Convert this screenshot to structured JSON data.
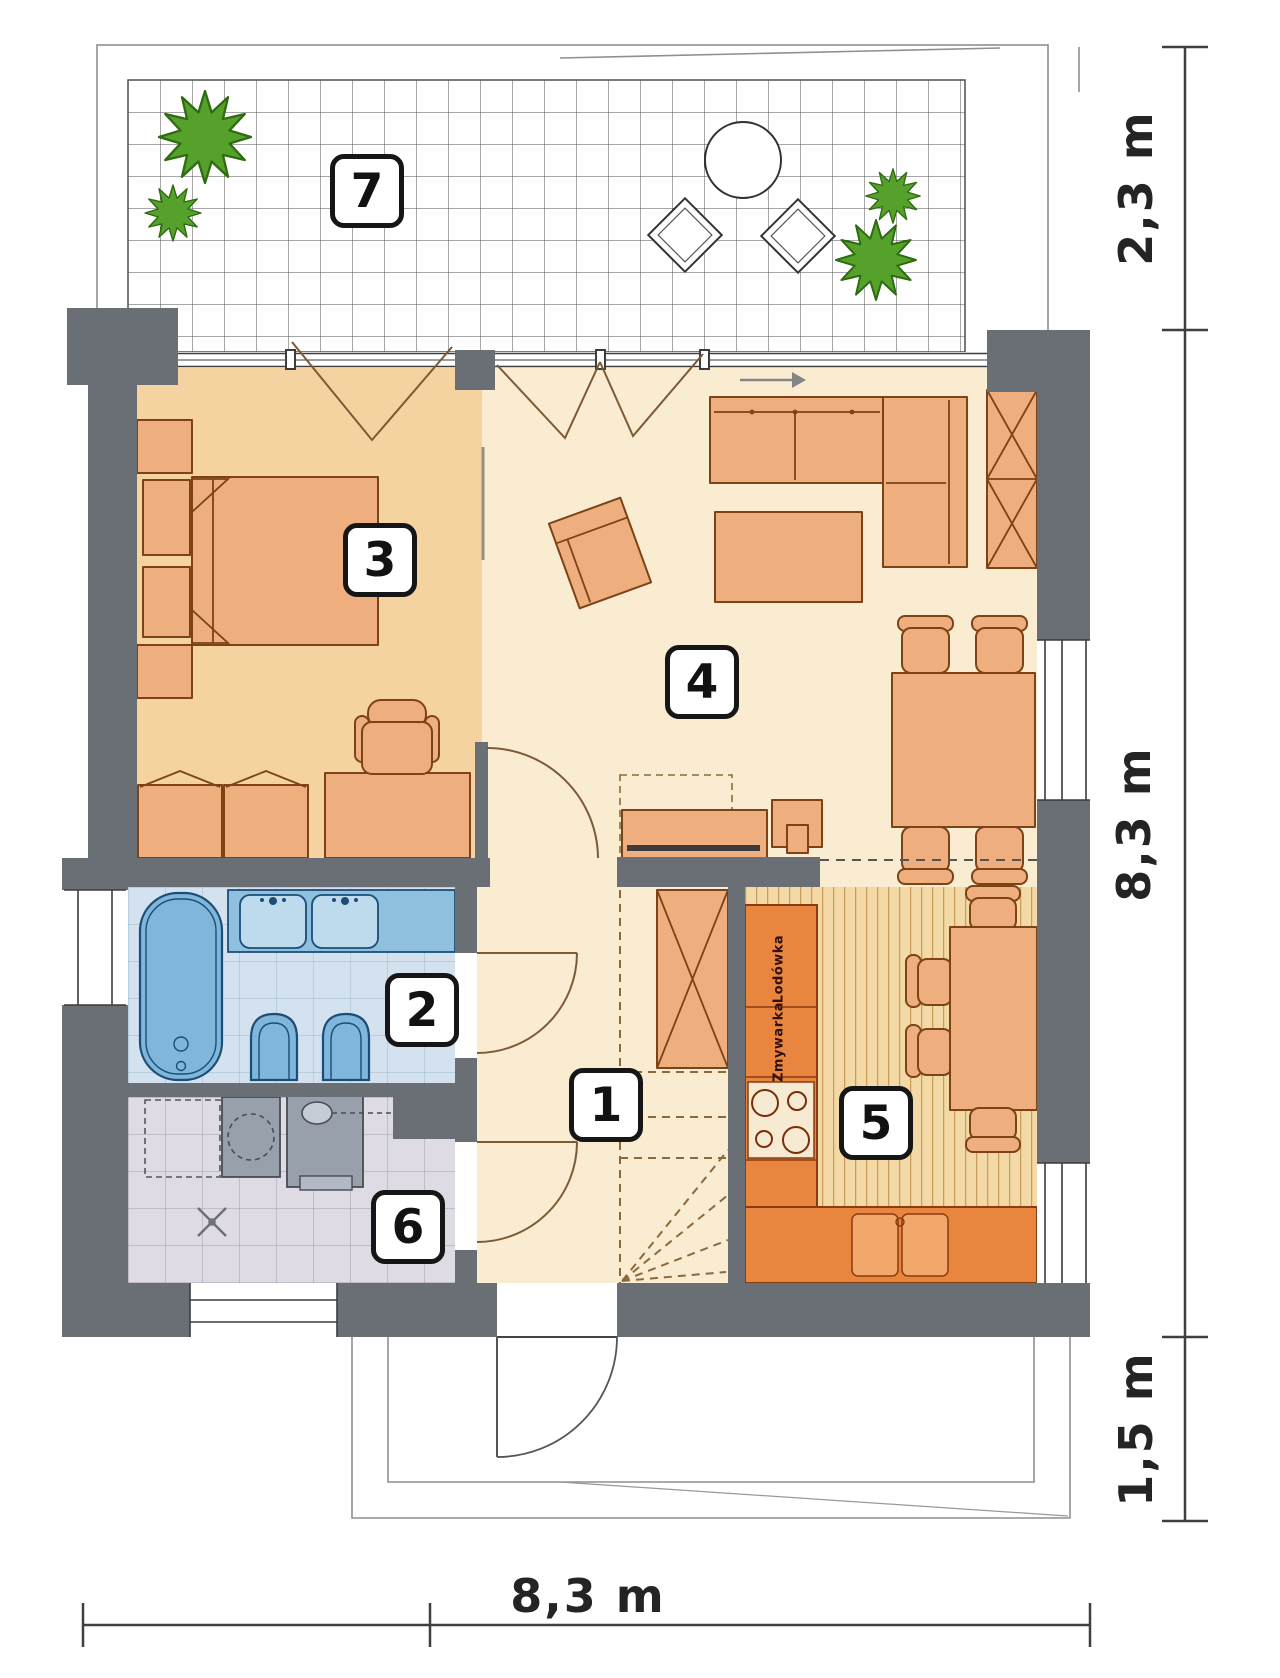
{
  "rooms": [
    {
      "number": "1"
    },
    {
      "number": "2"
    },
    {
      "number": "3"
    },
    {
      "number": "4"
    },
    {
      "number": "5"
    },
    {
      "number": "6"
    },
    {
      "number": "7"
    }
  ],
  "dimensions": {
    "terrace_depth": "2,3 m",
    "house_depth": "8,3 m",
    "porch_depth": "1,5 m",
    "house_width": "8,3 m"
  },
  "kitchen_appliances": {
    "fridge": "Lodówka",
    "dishwasher": "Zmywarka"
  },
  "colors": {
    "wall": "#6a6f76",
    "bedroom_floor": "#f4d3a0",
    "living_floor": "#f9ecd1",
    "kitchen_floor": "#f3d9a6",
    "bathroom_floor": "#d3e2ee",
    "utility_floor": "#dfdbe4",
    "furniture": "#efae7e",
    "kitchen_counter": "#e8853f",
    "bath_fixture": "#7fb6da",
    "plant": "#55a12c"
  }
}
